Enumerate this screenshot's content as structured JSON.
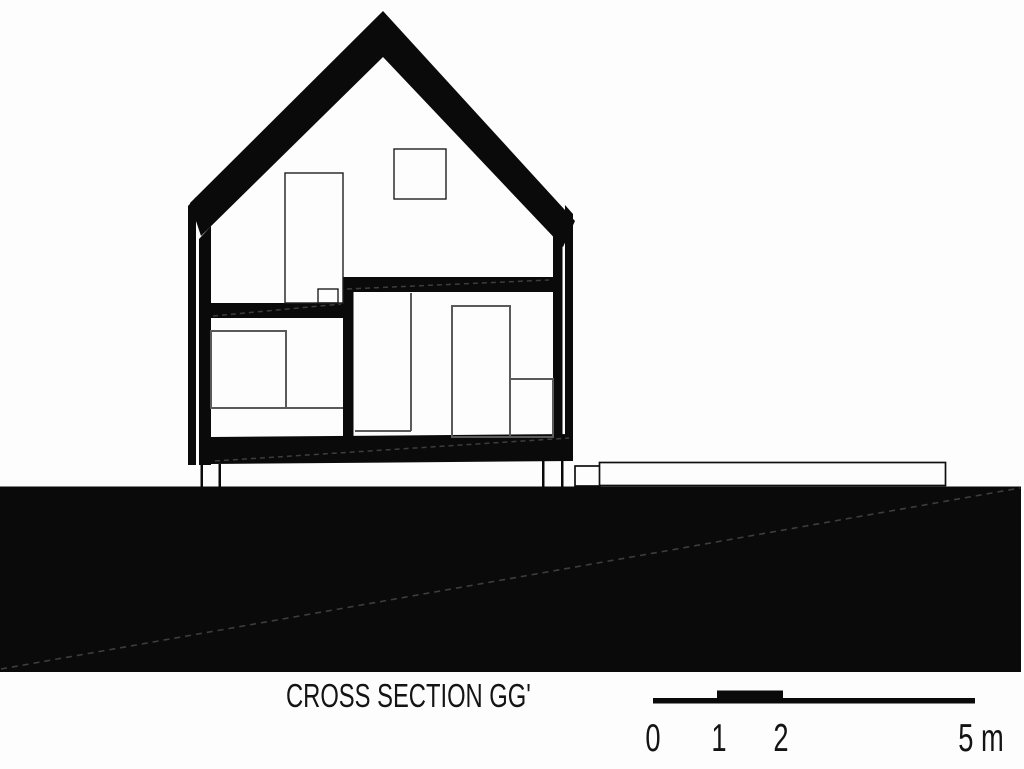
{
  "drawing": {
    "type": "architectural-section",
    "title": "CROSS SECTION GG'",
    "scale_bar": {
      "labels": [
        "0",
        "1",
        "2",
        "5 m"
      ],
      "unit": "m"
    },
    "colors": {
      "ink": "#0a0a0a",
      "background": "#fdfdfd",
      "furniture_line": "#5a5a5a",
      "hatch_line": "#3d3d3d"
    }
  }
}
